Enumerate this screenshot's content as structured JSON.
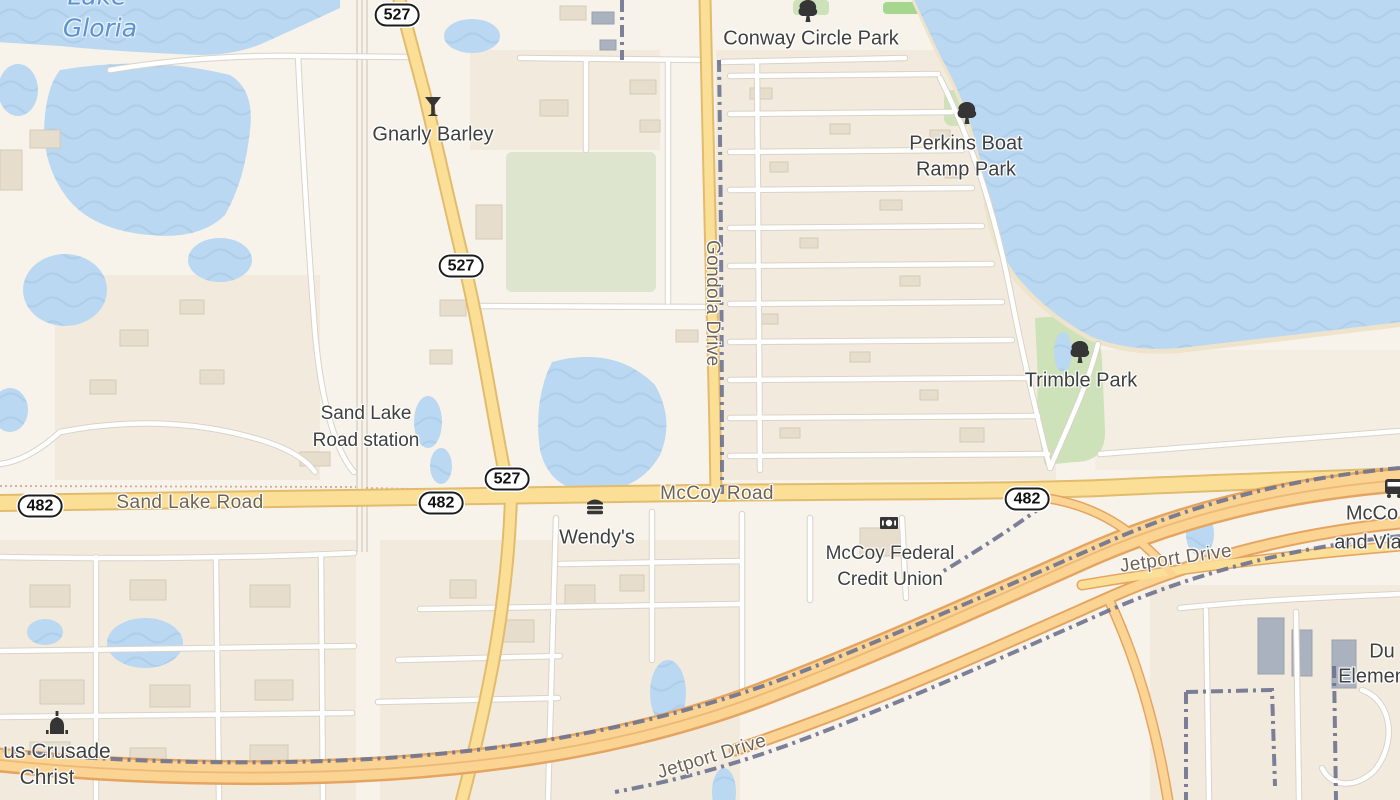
{
  "map": {
    "water_label": {
      "line1": "Lake",
      "line2": "Gloria"
    },
    "pois": {
      "conway_circle_park": {
        "label": "Conway Circle Park",
        "icon": "tree-icon"
      },
      "perkins_boat_ramp": {
        "line1": "Perkins Boat",
        "line2": "Ramp Park",
        "icon": "tree-icon"
      },
      "trimble_park": {
        "label": "Trimble Park",
        "icon": "tree-icon"
      },
      "gnarly_barley": {
        "label": "Gnarly Barley",
        "icon": "cocktail-icon"
      },
      "sand_lake_station": {
        "line1": "Sand Lake",
        "line2": "Road station"
      },
      "wendys": {
        "label": "Wendy's",
        "icon": "burger-icon"
      },
      "mccoy_credit_union": {
        "line1": "McCoy Federal",
        "line2": "Credit Union",
        "icon": "bank-icon"
      },
      "crusade_church": {
        "line1": "us Crusade",
        "line2": "Christ",
        "icon": "church-icon"
      },
      "mccoy_via_stop": {
        "line1": "McCo",
        "line2": "and Via",
        "icon": "bus-icon"
      },
      "elementary_school": {
        "line1": "Du",
        "line2": "Elemen"
      }
    },
    "road_labels": {
      "sand_lake_road": "Sand Lake Road",
      "mccoy_road": "McCoy Road",
      "gondola_drive": "Gondola Drive",
      "jetport_drive_ne": "Jetport Drive",
      "jetport_drive_sw": "Jetport Drive"
    },
    "shields": {
      "route_527": "527",
      "route_482": "482"
    },
    "colors": {
      "water": "#bad8f2",
      "water_wave": "#a6c6e4",
      "land": "#f7f3ea",
      "major_road": "#fbdf96",
      "highway": "#fbd393",
      "highway_casing": "#e5a561",
      "minor_road": "#ffffff",
      "boundary": "#6e7390",
      "park_green": "#cde2b8",
      "label_text": "#3f4040",
      "road_label_text": "#6f6354",
      "water_label_text": "#5d94d0"
    }
  }
}
